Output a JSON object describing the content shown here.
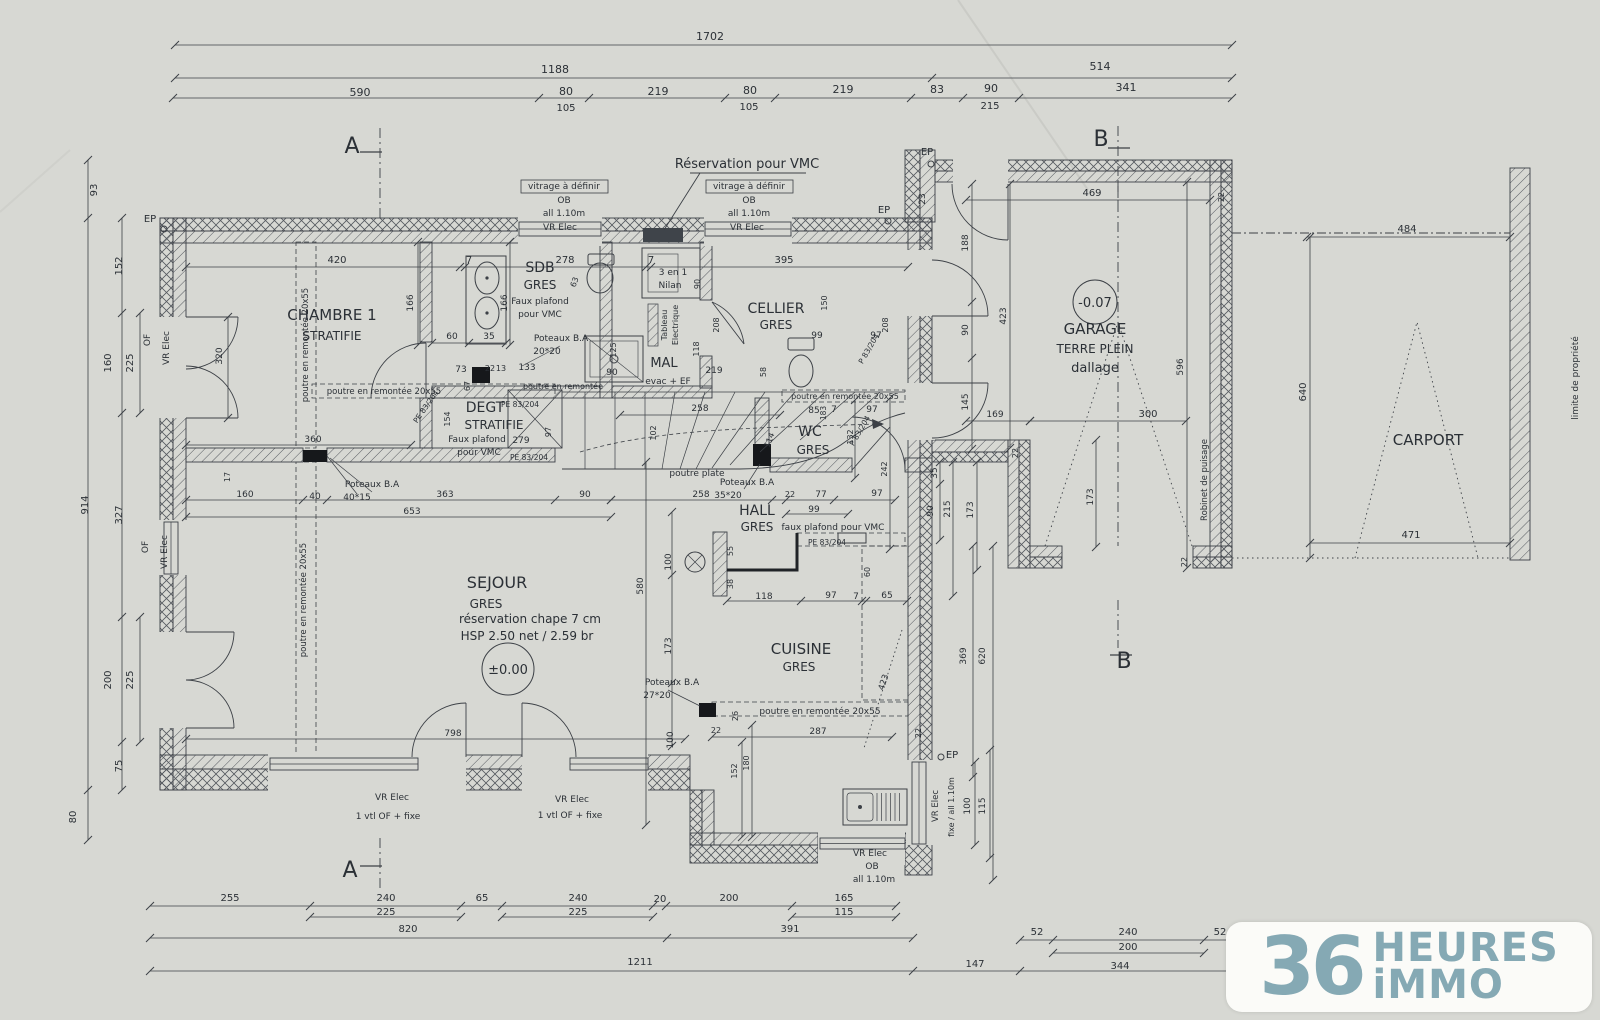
{
  "drawing": {
    "type": "architectural floor plan",
    "level": "rez-de-chaussee"
  },
  "logo": {
    "number": "36",
    "word1": "HEURES",
    "word2": "iMMO",
    "color": "#85a9b4"
  },
  "texts": [
    {
      "n": "dim-total-top",
      "t": "1702",
      "x": 710,
      "y": 40,
      "s": 11
    },
    {
      "t": "1188",
      "x": 555,
      "y": 73,
      "s": 11
    },
    {
      "t": "514",
      "x": 1100,
      "y": 70,
      "s": 11
    },
    {
      "t": "590",
      "x": 360,
      "y": 96,
      "s": 11
    },
    {
      "t": "80",
      "x": 566,
      "y": 95,
      "s": 11
    },
    {
      "t": "219",
      "x": 658,
      "y": 95,
      "s": 11
    },
    {
      "t": "80",
      "x": 750,
      "y": 94,
      "s": 11
    },
    {
      "t": "219",
      "x": 843,
      "y": 93,
      "s": 11
    },
    {
      "t": "83",
      "x": 937,
      "y": 93,
      "s": 11
    },
    {
      "t": "90",
      "x": 991,
      "y": 92,
      "s": 11
    },
    {
      "t": "341",
      "x": 1126,
      "y": 91,
      "s": 11
    },
    {
      "t": "105",
      "x": 566,
      "y": 111,
      "s": 10
    },
    {
      "t": "105",
      "x": 749,
      "y": 110,
      "s": 10
    },
    {
      "t": "215",
      "x": 990,
      "y": 109,
      "s": 10
    },
    {
      "n": "section-mark-a-top",
      "t": "A",
      "x": 352,
      "y": 153,
      "s": 22
    },
    {
      "n": "section-mark-b-top",
      "t": "B",
      "x": 1101,
      "y": 146,
      "s": 22
    },
    {
      "n": "section-mark-a-bottom",
      "t": "A",
      "x": 350,
      "y": 877,
      "s": 22
    },
    {
      "n": "section-mark-b-bottom",
      "t": "B",
      "x": 1124,
      "y": 668,
      "s": 22
    },
    {
      "n": "note-vmc",
      "t": "Réservation pour VMC",
      "x": 747,
      "y": 168,
      "s": 13
    },
    {
      "t": "vitrage à définir",
      "x": 564,
      "y": 189,
      "s": 9
    },
    {
      "t": "vitrage à définir",
      "x": 749,
      "y": 189,
      "s": 9
    },
    {
      "t": "OB",
      "x": 564,
      "y": 203,
      "s": 9
    },
    {
      "t": "OB",
      "x": 749,
      "y": 203,
      "s": 9
    },
    {
      "t": "all 1.10m",
      "x": 564,
      "y": 216,
      "s": 9
    },
    {
      "t": "all 1.10m",
      "x": 749,
      "y": 216,
      "s": 9
    },
    {
      "t": "VR Elec",
      "x": 560,
      "y": 230,
      "s": 9
    },
    {
      "t": "VR Elec",
      "x": 747,
      "y": 230,
      "s": 9
    },
    {
      "t": "EP",
      "x": 884,
      "y": 213,
      "s": 10
    },
    {
      "t": "EP",
      "x": 927,
      "y": 155,
      "s": 10
    },
    {
      "t": "23",
      "x": 925,
      "y": 199,
      "s": 9,
      "r": -90
    },
    {
      "t": "EP",
      "x": 150,
      "y": 222,
      "s": 10
    },
    {
      "t": "420",
      "x": 337,
      "y": 263,
      "s": 10
    },
    {
      "t": "7",
      "x": 469,
      "y": 263,
      "s": 10
    },
    {
      "t": "278",
      "x": 565,
      "y": 263,
      "s": 10
    },
    {
      "t": "7",
      "x": 651,
      "y": 263,
      "s": 10
    },
    {
      "t": "395",
      "x": 784,
      "y": 263,
      "s": 10
    },
    {
      "n": "room-chambre1",
      "t": "CHAMBRE 1",
      "x": 332,
      "y": 320,
      "s": 15
    },
    {
      "t": "STRATIFIE",
      "x": 332,
      "y": 340,
      "s": 12
    },
    {
      "t": "166",
      "x": 413,
      "y": 303,
      "s": 9,
      "r": -90
    },
    {
      "t": "166",
      "x": 507,
      "y": 303,
      "s": 9,
      "r": -90
    },
    {
      "t": "320",
      "x": 222,
      "y": 356,
      "s": 9,
      "r": -90
    },
    {
      "t": "OF",
      "x": 150,
      "y": 340,
      "s": 9,
      "r": -90
    },
    {
      "t": "VR Elec",
      "x": 169,
      "y": 348,
      "s": 9,
      "r": -90
    },
    {
      "t": "OF",
      "x": 148,
      "y": 547,
      "s": 9,
      "r": -90
    },
    {
      "t": "VR Elec",
      "x": 167,
      "y": 552,
      "s": 9,
      "r": -90
    },
    {
      "t": "60",
      "x": 452,
      "y": 339,
      "s": 9
    },
    {
      "t": "35",
      "x": 489,
      "y": 339,
      "s": 9
    },
    {
      "t": "73",
      "x": 461,
      "y": 372,
      "s": 9
    },
    {
      "t": "67",
      "x": 470,
      "y": 386,
      "s": 8,
      "r": -90
    },
    {
      "t": "22",
      "x": 490,
      "y": 371,
      "s": 8
    },
    {
      "t": "13",
      "x": 501,
      "y": 371,
      "s": 8
    },
    {
      "t": "133",
      "x": 527,
      "y": 370,
      "s": 9
    },
    {
      "t": "poutre en remontée 20x55",
      "x": 308,
      "y": 345,
      "s": 8.5,
      "r": -90
    },
    {
      "t": "poutre en remontée 20x55",
      "x": 306,
      "y": 600,
      "s": 8.5,
      "r": -90
    },
    {
      "t": "poutre en remontée 20x55",
      "x": 384,
      "y": 394,
      "s": 8.5
    },
    {
      "t": "poutre en remontée",
      "x": 563,
      "y": 389,
      "s": 8
    },
    {
      "t": "360",
      "x": 313,
      "y": 442,
      "s": 9
    },
    {
      "t": "17",
      "x": 230,
      "y": 477,
      "s": 8,
      "r": -90
    },
    {
      "n": "room-sdb",
      "t": "SDB",
      "x": 540,
      "y": 272,
      "s": 14
    },
    {
      "t": "GRES",
      "x": 540,
      "y": 289,
      "s": 12
    },
    {
      "t": "Faux plafond",
      "x": 540,
      "y": 304,
      "s": 9
    },
    {
      "t": "pour VMC",
      "x": 540,
      "y": 317,
      "s": 9
    },
    {
      "t": "Poteaux B.A",
      "x": 561,
      "y": 341,
      "s": 9
    },
    {
      "t": "20*20",
      "x": 547,
      "y": 354,
      "s": 9
    },
    {
      "t": "63",
      "x": 577,
      "y": 283,
      "s": 8,
      "r": -70
    },
    {
      "t": "125",
      "x": 616,
      "y": 350,
      "s": 8,
      "r": -90
    },
    {
      "t": "90",
      "x": 612,
      "y": 375,
      "s": 9
    },
    {
      "n": "room-mal",
      "t": "MAL",
      "x": 664,
      "y": 367,
      "s": 13
    },
    {
      "t": "evac + EF",
      "x": 668,
      "y": 384,
      "s": 9
    },
    {
      "t": "3 en 1",
      "x": 673,
      "y": 275,
      "s": 9
    },
    {
      "t": "Nilan",
      "x": 670,
      "y": 288,
      "s": 9
    },
    {
      "t": "90",
      "x": 700,
      "y": 284,
      "s": 8,
      "r": -90
    },
    {
      "t": "Tableau",
      "x": 667,
      "y": 325,
      "s": 8,
      "r": -90
    },
    {
      "t": "Electrique",
      "x": 678,
      "y": 325,
      "s": 8,
      "r": -90
    },
    {
      "t": "118",
      "x": 699,
      "y": 349,
      "s": 8,
      "r": -90
    },
    {
      "t": "208",
      "x": 719,
      "y": 325,
      "s": 8,
      "r": -90
    },
    {
      "t": "219",
      "x": 714,
      "y": 373,
      "s": 9
    },
    {
      "t": "58",
      "x": 766,
      "y": 372,
      "s": 8,
      "r": -90
    },
    {
      "n": "room-cellier",
      "t": "CELLIER",
      "x": 776,
      "y": 313,
      "s": 14
    },
    {
      "t": "GRES",
      "x": 776,
      "y": 329,
      "s": 12
    },
    {
      "t": "150",
      "x": 827,
      "y": 303,
      "s": 8,
      "r": -90
    },
    {
      "t": "99",
      "x": 817,
      "y": 338,
      "s": 9
    },
    {
      "t": "97",
      "x": 876,
      "y": 338,
      "s": 9
    },
    {
      "t": "208",
      "x": 888,
      "y": 325,
      "s": 8,
      "r": -90
    },
    {
      "t": "P 83/204",
      "x": 871,
      "y": 350,
      "s": 7.5,
      "r": -60
    },
    {
      "t": "P 83/204",
      "x": 862,
      "y": 432,
      "s": 7.5,
      "r": -60
    },
    {
      "t": "PE 83/204",
      "x": 428,
      "y": 408,
      "s": 7.5,
      "r": -55
    },
    {
      "n": "room-degt",
      "t": "DEGT",
      "x": 485,
      "y": 412,
      "s": 14
    },
    {
      "t": "STRATIFIE",
      "x": 494,
      "y": 429,
      "s": 12
    },
    {
      "t": "Faux plafond",
      "x": 477,
      "y": 442,
      "s": 9
    },
    {
      "t": "279",
      "x": 521,
      "y": 443,
      "s": 9
    },
    {
      "t": "pour VMC",
      "x": 479,
      "y": 455,
      "s": 9
    },
    {
      "t": "PE 83/204",
      "x": 520,
      "y": 407,
      "s": 7.5
    },
    {
      "t": "PE 83/204",
      "x": 529,
      "y": 460,
      "s": 7.5
    },
    {
      "t": "154",
      "x": 450,
      "y": 419,
      "s": 8,
      "r": -90
    },
    {
      "t": "97",
      "x": 551,
      "y": 432,
      "s": 8,
      "r": -90
    },
    {
      "t": "258",
      "x": 700,
      "y": 411,
      "s": 9
    },
    {
      "t": "102",
      "x": 656,
      "y": 433,
      "s": 8,
      "r": -90
    },
    {
      "t": "114",
      "x": 772,
      "y": 441,
      "s": 8,
      "r": -70
    },
    {
      "t": "poutre plate",
      "x": 697,
      "y": 476,
      "s": 9
    },
    {
      "t": "Poteaux B.A",
      "x": 372,
      "y": 487,
      "s": 9
    },
    {
      "t": "40*15",
      "x": 357,
      "y": 500,
      "s": 9
    },
    {
      "t": "160",
      "x": 245,
      "y": 497,
      "s": 9
    },
    {
      "t": "40",
      "x": 315,
      "y": 499,
      "s": 9
    },
    {
      "t": "363",
      "x": 445,
      "y": 497,
      "s": 9
    },
    {
      "t": "90",
      "x": 585,
      "y": 497,
      "s": 9
    },
    {
      "t": "653",
      "x": 412,
      "y": 514,
      "s": 9
    },
    {
      "t": "258",
      "x": 701,
      "y": 497,
      "s": 9
    },
    {
      "t": "Poteaux B.A",
      "x": 747,
      "y": 485,
      "s": 9
    },
    {
      "t": "35*20",
      "x": 728,
      "y": 498,
      "s": 9
    },
    {
      "n": "room-hall",
      "t": "HALL",
      "x": 757,
      "y": 515,
      "s": 14
    },
    {
      "t": "GRES",
      "x": 757,
      "y": 531,
      "s": 12
    },
    {
      "t": "22",
      "x": 790,
      "y": 497,
      "s": 8
    },
    {
      "t": "77",
      "x": 821,
      "y": 497,
      "s": 9
    },
    {
      "t": "97",
      "x": 877,
      "y": 496,
      "s": 9
    },
    {
      "t": "99",
      "x": 814,
      "y": 512,
      "s": 9
    },
    {
      "t": "faux plafond pour VMC",
      "x": 833,
      "y": 530,
      "s": 9
    },
    {
      "t": "PE 83/204",
      "x": 827,
      "y": 545,
      "s": 7.5
    },
    {
      "t": "55",
      "x": 733,
      "y": 551,
      "s": 8,
      "r": -90
    },
    {
      "t": "38",
      "x": 733,
      "y": 584,
      "s": 8,
      "r": -90
    },
    {
      "t": "118",
      "x": 764,
      "y": 599,
      "s": 9
    },
    {
      "t": "97",
      "x": 831,
      "y": 598,
      "s": 9
    },
    {
      "t": "7",
      "x": 856,
      "y": 599,
      "s": 9
    },
    {
      "t": "65",
      "x": 887,
      "y": 598,
      "s": 9
    },
    {
      "t": "60",
      "x": 870,
      "y": 572,
      "s": 8,
      "r": -90
    },
    {
      "n": "room-wc",
      "t": "WC",
      "x": 810,
      "y": 436,
      "s": 14
    },
    {
      "t": "GRES",
      "x": 813,
      "y": 454,
      "s": 12
    },
    {
      "t": "85",
      "x": 814,
      "y": 413,
      "s": 9
    },
    {
      "t": "183",
      "x": 826,
      "y": 413,
      "s": 7.5,
      "r": -90
    },
    {
      "t": "7",
      "x": 834,
      "y": 412,
      "s": 9
    },
    {
      "t": "97",
      "x": 872,
      "y": 412,
      "s": 9
    },
    {
      "t": "132",
      "x": 853,
      "y": 437,
      "s": 8,
      "r": -90
    },
    {
      "t": "242",
      "x": 887,
      "y": 469,
      "s": 8,
      "r": -90
    },
    {
      "t": "poutre en remontée 20x55",
      "x": 845,
      "y": 399,
      "s": 8
    },
    {
      "n": "room-sejour",
      "t": "SEJOUR",
      "x": 497,
      "y": 588,
      "s": 16
    },
    {
      "t": "GRES",
      "x": 486,
      "y": 608,
      "s": 12
    },
    {
      "t": "réservation chape 7 cm",
      "x": 530,
      "y": 623,
      "s": 12
    },
    {
      "t": "HSP 2.50 net / 2.59 br",
      "x": 527,
      "y": 640,
      "s": 12
    },
    {
      "n": "level-sejour",
      "t": "±0.00",
      "x": 508,
      "y": 674,
      "s": 13
    },
    {
      "t": "580",
      "x": 643,
      "y": 586,
      "s": 9,
      "r": -90
    },
    {
      "t": "100",
      "x": 671,
      "y": 562,
      "s": 9,
      "r": -90
    },
    {
      "t": "173",
      "x": 671,
      "y": 646,
      "s": 9,
      "r": -90
    },
    {
      "t": "100",
      "x": 673,
      "y": 740,
      "s": 9,
      "r": -90
    },
    {
      "t": "Poteaux B.A",
      "x": 672,
      "y": 685,
      "s": 9
    },
    {
      "t": "27*20",
      "x": 657,
      "y": 698,
      "s": 9
    },
    {
      "t": "798",
      "x": 453,
      "y": 736,
      "s": 9
    },
    {
      "n": "room-cuisine",
      "t": "CUISINE",
      "x": 801,
      "y": 654,
      "s": 15
    },
    {
      "t": "GRES",
      "x": 799,
      "y": 671,
      "s": 12
    },
    {
      "t": "423",
      "x": 886,
      "y": 683,
      "s": 8.5,
      "r": -72
    },
    {
      "t": "26",
      "x": 738,
      "y": 716,
      "s": 8,
      "r": -90
    },
    {
      "t": "poutre en remontée 20x55",
      "x": 820,
      "y": 714,
      "s": 9
    },
    {
      "t": "287",
      "x": 818,
      "y": 734,
      "s": 9
    },
    {
      "t": "152",
      "x": 737,
      "y": 771,
      "s": 8,
      "r": -90
    },
    {
      "t": "180",
      "x": 749,
      "y": 763,
      "s": 8,
      "r": -90
    },
    {
      "t": "22",
      "x": 716,
      "y": 733,
      "s": 8
    },
    {
      "t": "22",
      "x": 921,
      "y": 733,
      "s": 8,
      "r": -90
    },
    {
      "t": "EP",
      "x": 952,
      "y": 758,
      "s": 10
    },
    {
      "t": "VR Elec",
      "x": 938,
      "y": 806,
      "s": 8.5,
      "r": -90
    },
    {
      "t": "fixe / all 1.10m",
      "x": 954,
      "y": 807,
      "s": 8,
      "r": -90
    },
    {
      "t": "100",
      "x": 970,
      "y": 806,
      "s": 9,
      "r": -90
    },
    {
      "t": "115",
      "x": 985,
      "y": 806,
      "s": 9,
      "r": -90
    },
    {
      "t": "VR Elec",
      "x": 870,
      "y": 856,
      "s": 9
    },
    {
      "t": "OB",
      "x": 872,
      "y": 869,
      "s": 9
    },
    {
      "t": "all 1.10m",
      "x": 874,
      "y": 882,
      "s": 9
    },
    {
      "t": "369",
      "x": 966,
      "y": 656,
      "s": 9,
      "r": -90
    },
    {
      "t": "620",
      "x": 985,
      "y": 656,
      "s": 9,
      "r": -90
    },
    {
      "t": "VR Elec",
      "x": 392,
      "y": 800,
      "s": 9
    },
    {
      "t": "1 vtl OF + fixe",
      "x": 388,
      "y": 819,
      "s": 9
    },
    {
      "t": "VR Elec",
      "x": 572,
      "y": 802,
      "s": 9
    },
    {
      "t": "1 vtl OF + fixe",
      "x": 570,
      "y": 818,
      "s": 9
    },
    {
      "t": "93",
      "x": 97,
      "y": 190,
      "s": 10,
      "r": -90
    },
    {
      "t": "914",
      "x": 88,
      "y": 505,
      "s": 10,
      "r": -90
    },
    {
      "t": "80",
      "x": 76,
      "y": 817,
      "s": 10,
      "r": -90
    },
    {
      "t": "152",
      "x": 122,
      "y": 266,
      "s": 10,
      "r": -90
    },
    {
      "t": "160",
      "x": 111,
      "y": 363,
      "s": 10,
      "r": -90
    },
    {
      "t": "225",
      "x": 133,
      "y": 363,
      "s": 10,
      "r": -90
    },
    {
      "t": "327",
      "x": 122,
      "y": 515,
      "s": 10,
      "r": -90
    },
    {
      "t": "200",
      "x": 111,
      "y": 680,
      "s": 10,
      "r": -90
    },
    {
      "t": "225",
      "x": 133,
      "y": 680,
      "s": 10,
      "r": -90
    },
    {
      "t": "75",
      "x": 122,
      "y": 766,
      "s": 10,
      "r": -90
    },
    {
      "t": "188",
      "x": 968,
      "y": 243,
      "s": 9,
      "r": -90
    },
    {
      "t": "90",
      "x": 968,
      "y": 330,
      "s": 9,
      "r": -90
    },
    {
      "t": "145",
      "x": 968,
      "y": 402,
      "s": 9,
      "r": -90
    },
    {
      "t": "423",
      "x": 1006,
      "y": 316,
      "s": 9,
      "r": -90
    },
    {
      "t": "169",
      "x": 995,
      "y": 417,
      "s": 9
    },
    {
      "t": "300",
      "x": 1148,
      "y": 417,
      "s": 10
    },
    {
      "t": "469",
      "x": 1092,
      "y": 196,
      "s": 10
    },
    {
      "t": "596",
      "x": 1183,
      "y": 367,
      "s": 9,
      "r": -90
    },
    {
      "n": "level-garage",
      "t": "-0.07",
      "x": 1095,
      "y": 307,
      "s": 13
    },
    {
      "n": "room-garage",
      "t": "GARAGE",
      "x": 1095,
      "y": 334,
      "s": 15
    },
    {
      "t": "TERRE PLEIN",
      "x": 1095,
      "y": 353,
      "s": 12
    },
    {
      "t": "dallage",
      "x": 1095,
      "y": 372,
      "s": 13
    },
    {
      "t": "22",
      "x": 1224,
      "y": 197,
      "s": 8,
      "r": -90
    },
    {
      "t": "22",
      "x": 1018,
      "y": 453,
      "s": 8,
      "r": -90
    },
    {
      "t": "22",
      "x": 1187,
      "y": 562,
      "s": 8,
      "r": -90
    },
    {
      "t": "35",
      "x": 937,
      "y": 473,
      "s": 9,
      "r": -90
    },
    {
      "t": "90",
      "x": 933,
      "y": 511,
      "s": 9,
      "r": -90
    },
    {
      "t": "215",
      "x": 950,
      "y": 509,
      "s": 9,
      "r": -90
    },
    {
      "t": "173",
      "x": 973,
      "y": 510,
      "s": 9,
      "r": -90
    },
    {
      "t": "173",
      "x": 1093,
      "y": 497,
      "s": 9,
      "r": -90
    },
    {
      "t": "Robinet de puisage",
      "x": 1207,
      "y": 480,
      "s": 8.5,
      "r": -90
    },
    {
      "t": "484",
      "x": 1407,
      "y": 232,
      "s": 10
    },
    {
      "t": "640",
      "x": 1306,
      "y": 392,
      "s": 10,
      "r": -90
    },
    {
      "n": "room-carport",
      "t": "CARPORT",
      "x": 1428,
      "y": 445,
      "s": 15
    },
    {
      "t": "471",
      "x": 1411,
      "y": 538,
      "s": 10
    },
    {
      "n": "note-limite",
      "t": "limite de propriété",
      "x": 1578,
      "y": 378,
      "s": 9,
      "r": -90
    },
    {
      "t": "255",
      "x": 230,
      "y": 901,
      "s": 10
    },
    {
      "t": "240",
      "x": 386,
      "y": 901,
      "s": 10
    },
    {
      "t": "65",
      "x": 482,
      "y": 901,
      "s": 10
    },
    {
      "t": "240",
      "x": 578,
      "y": 901,
      "s": 10
    },
    {
      "t": "20",
      "x": 660,
      "y": 902,
      "s": 10
    },
    {
      "t": "200",
      "x": 729,
      "y": 901,
      "s": 10
    },
    {
      "t": "165",
      "x": 844,
      "y": 901,
      "s": 10
    },
    {
      "t": "225",
      "x": 386,
      "y": 915,
      "s": 10
    },
    {
      "t": "225",
      "x": 578,
      "y": 915,
      "s": 10
    },
    {
      "t": "115",
      "x": 844,
      "y": 915,
      "s": 10
    },
    {
      "t": "820",
      "x": 408,
      "y": 932,
      "s": 10
    },
    {
      "t": "391",
      "x": 790,
      "y": 932,
      "s": 10
    },
    {
      "t": "52",
      "x": 1037,
      "y": 935,
      "s": 10
    },
    {
      "t": "240",
      "x": 1128,
      "y": 935,
      "s": 10
    },
    {
      "t": "52",
      "x": 1220,
      "y": 935,
      "s": 10
    },
    {
      "t": "200",
      "x": 1128,
      "y": 950,
      "s": 10
    },
    {
      "n": "dim-total-bottom",
      "t": "1211",
      "x": 640,
      "y": 965,
      "s": 10
    },
    {
      "t": "147",
      "x": 975,
      "y": 967,
      "s": 10
    },
    {
      "t": "344",
      "x": 1120,
      "y": 969,
      "s": 10
    }
  ]
}
